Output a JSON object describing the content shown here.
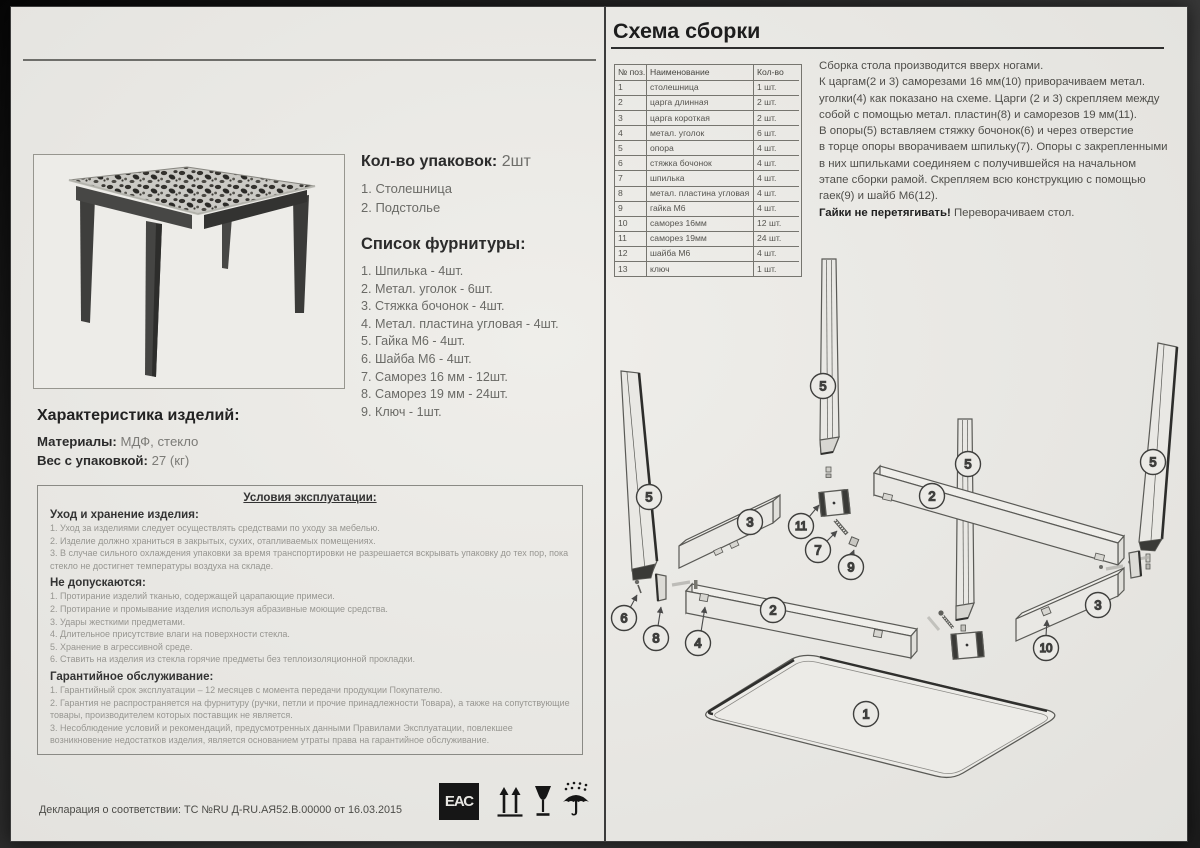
{
  "left": {
    "packages": {
      "label": "Кол-во упаковок:",
      "value": "2шт",
      "items": [
        "1. Столешница",
        "2. Подстолье"
      ]
    },
    "hardware": {
      "title": "Список фурнитуры:",
      "items": [
        "1. Шпилька - 4шт.",
        "2. Метал. уголок - 6шт.",
        "3. Стяжка бочонок - 4шт.",
        "4. Метал. пластина угловая - 4шт.",
        "5. Гайка М6 - 4шт.",
        "6. Шайба М6 - 4шт.",
        "7. Саморез 16 мм - 12шт.",
        "8. Саморез 19 мм - 24шт.",
        "9. Ключ - 1шт."
      ]
    },
    "characteristics": {
      "title": "Характеристика изделий:",
      "rows": [
        {
          "label": "Материалы:",
          "value": "МДФ, стекло"
        },
        {
          "label": "Вес с упаковкой:",
          "value": "27 (кг)"
        }
      ]
    },
    "conditions": {
      "title": "Условия эксплуатации:",
      "sections": [
        {
          "heading": "Уход и хранение изделия:",
          "items": [
            "1. Уход за изделиями следует осуществлять средствами по уходу за мебелью.",
            "2. Изделие должно храниться в закрытых, сухих, отапливаемых помещениях.",
            "3. В случае сильного охлаждения упаковки за время транспортировки не разрешается вскрывать упаковку до тех пор, пока стекло не достигнет температуры воздуха на складе."
          ]
        },
        {
          "heading": "Не допускаются:",
          "items": [
            "1. Протирание изделий тканью, содержащей царапающие примеси.",
            "2. Протирание и промывание изделия используя абразивные моющие средства.",
            "3. Удары жесткими предметами.",
            "4. Длительное присутствие влаги на поверхности стекла.",
            "5. Хранение в агрессивной среде.",
            "6. Ставить на изделия из стекла горячие предметы без теплоизоляционной прокладки."
          ]
        },
        {
          "heading": "Гарантийное обслуживание:",
          "items": [
            "1. Гарантийный срок эксплуатации – 12 месяцев с момента передачи продукции Покупателю.",
            "2. Гарантия не распространяется на фурнитуру (ручки, петли и прочие принадлежности Товара), а также на сопутствующие товары, производителем которых поставщик не является.",
            "3. Несоблюдение условий и рекомендаций, предусмотренных данными Правилами Эксплуатации, повлекшее возникновение недостатков изделия, является основанием утраты права на гарантийное обслуживание."
          ]
        }
      ]
    },
    "declaration": "Декларация о соответствии: ТС №RU Д-RU.АЯ52.В.00000 от 16.03.2015",
    "eac_text": "ЕАС",
    "cert_icons": [
      "eac-mark",
      "this-side-up",
      "fragile",
      "keep-dry"
    ]
  },
  "right": {
    "title": "Схема сборки",
    "parts_table": {
      "headers": [
        "№ поз.",
        "Наименование",
        "Кол-во"
      ],
      "rows": [
        [
          "1",
          "столешница",
          "1 шт."
        ],
        [
          "2",
          "царга длинная",
          "2 шт."
        ],
        [
          "3",
          "царга короткая",
          "2 шт."
        ],
        [
          "4",
          "метал. уголок",
          "6 шт."
        ],
        [
          "5",
          "опора",
          "4 шт."
        ],
        [
          "6",
          "стяжка бочонок",
          "4 шт."
        ],
        [
          "7",
          "шпилька",
          "4 шт."
        ],
        [
          "8",
          "метал. пластина угловая",
          "4 шт."
        ],
        [
          "9",
          "гайка М6",
          "4 шт."
        ],
        [
          "10",
          "саморез 16мм",
          "12 шт."
        ],
        [
          "11",
          "саморез 19мм",
          "24 шт."
        ],
        [
          "12",
          "шайба М6",
          "4 шт."
        ],
        [
          "13",
          "ключ",
          "1 шт."
        ]
      ]
    },
    "instructions": {
      "lines": [
        "Сборка стола производится вверх ногами.",
        "К царгам(2 и 3) саморезами 16 мм(10) приворачиваем метал.",
        "уголки(4) как показано на схеме. Царги (2 и 3) скрепляем между",
        "собой с помощью метал. пластин(8) и саморезов 19 мм(11).",
        "В опоры(5) вставляем стяжку бочонок(6) и через отверстие",
        "в торце опоры вворачиваем  шпильку(7). Опоры с закрепленными",
        "в них шпильками соединяем с получившейся на начальном",
        "этапе сборки рамой. Скрепляем всю конструкцию с помощью",
        "гаек(9) и шайб М6(12)."
      ],
      "warning_bold": "Гайки не перетягивать!",
      "warning_rest": " Переворачиваем стол."
    },
    "diagram": {
      "callouts": [
        "1",
        "2",
        "3",
        "4",
        "5",
        "6",
        "7",
        "8",
        "9",
        "10",
        "11"
      ]
    }
  }
}
